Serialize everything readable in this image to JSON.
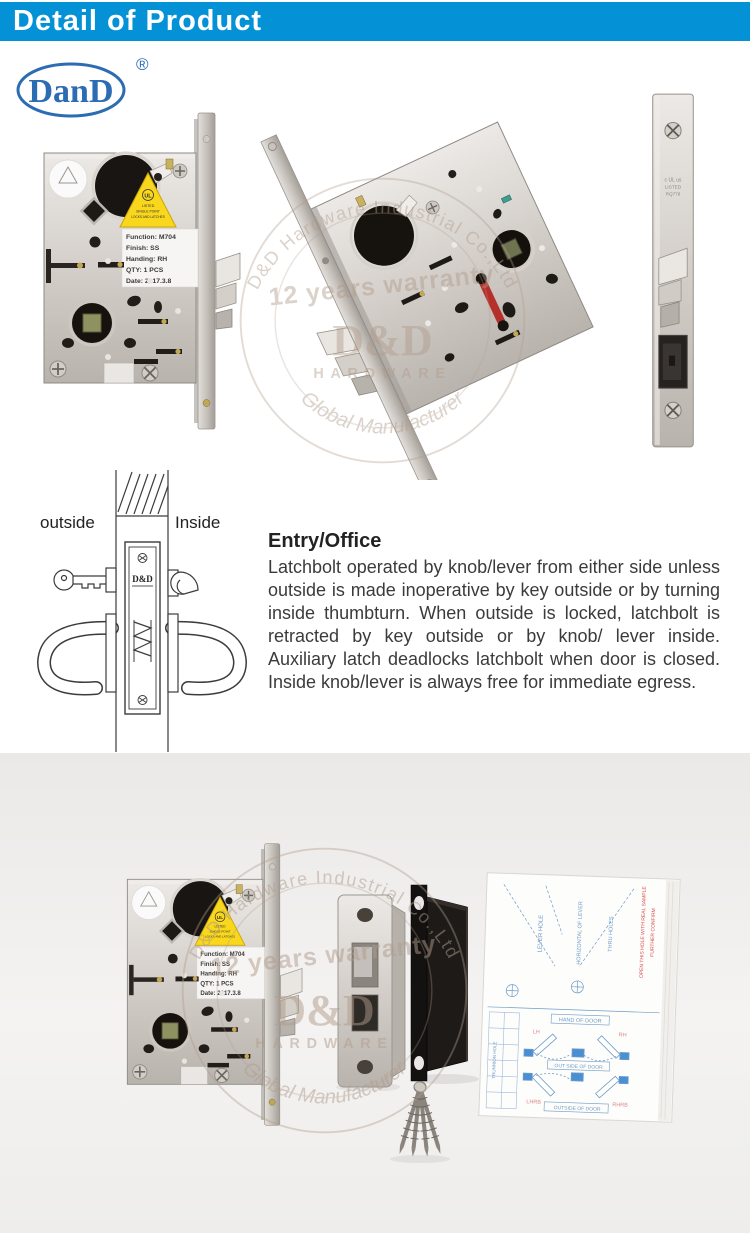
{
  "header": {
    "title": "Detail of Product"
  },
  "brand": {
    "logo_text": "DanD",
    "registered_mark": "®"
  },
  "colors": {
    "banner_blue": "#0591d6",
    "logo_blue": "#2b6cb3",
    "steel_gray": "#cdc8c2",
    "warning_yellow": "#f8d71c",
    "indicator_red": "#b5302a",
    "sheet_blue": "#6f9cc6",
    "sheet_note_red": "#d9534f",
    "bottom_bg": "#f0eeec",
    "watermark_tan": "#b09c8c"
  },
  "product_label": {
    "function": "Function: M704",
    "finish": "Finish: SS",
    "handing": "Handing: RH",
    "qty": "QTY: 1 PCS",
    "date": "Date: 2017.3.8"
  },
  "ul_label": {
    "mark": "UL",
    "line1": "LISTED",
    "line2": "SINGLE POINT",
    "line3": "LOCKS AND LATCHES"
  },
  "faceplate_stamp": {
    "line1": "c UL us",
    "line2": "LISTED",
    "line3": "RQ778"
  },
  "install_diagram": {
    "outside": "outside",
    "inside": "Inside",
    "plate_brand": "D&D"
  },
  "description": {
    "heading": "Entry/Office",
    "body": "Latchbolt operated by knob/lever from either side unless outside is made inoperative by key outside or by turning inside thumbturn. When outside is locked, latchbolt is retracted by key outside or by knob/ lever inside. Auxiliary latch deadlocks latchbolt when door is closed. Inside knob/lever is always free for immediate egress."
  },
  "watermark": {
    "arc_top": "D&D Hardware Industrial Co.,Ltd",
    "warranty": "12 years warranty",
    "brand": "D&D",
    "brand_sub": "HARDWARE",
    "arc_bottom": "Global Manufacturer"
  },
  "instruction_sheet": {
    "lever_hole": "LEVER HOLE",
    "horizontal_of_lever": "HORIZONTAL OF LEVER",
    "thru_holes": "THRU HOLES",
    "note_red_1": "OPEN THIS HOLE WITH REAL SAMPLE",
    "note_red_2": "FURTHER CONFIRM",
    "hand_of_door": "HAND OF DOOR",
    "lh": "LH",
    "rh": "RH",
    "lhrb": "LHRB",
    "rhrb": "RHRB",
    "out_side_of_door": "OUT SIDE OF DOOR",
    "outside_of_door": "OUTSIDE OF DOOR",
    "trunnion": "TRUNNION HOLE"
  }
}
